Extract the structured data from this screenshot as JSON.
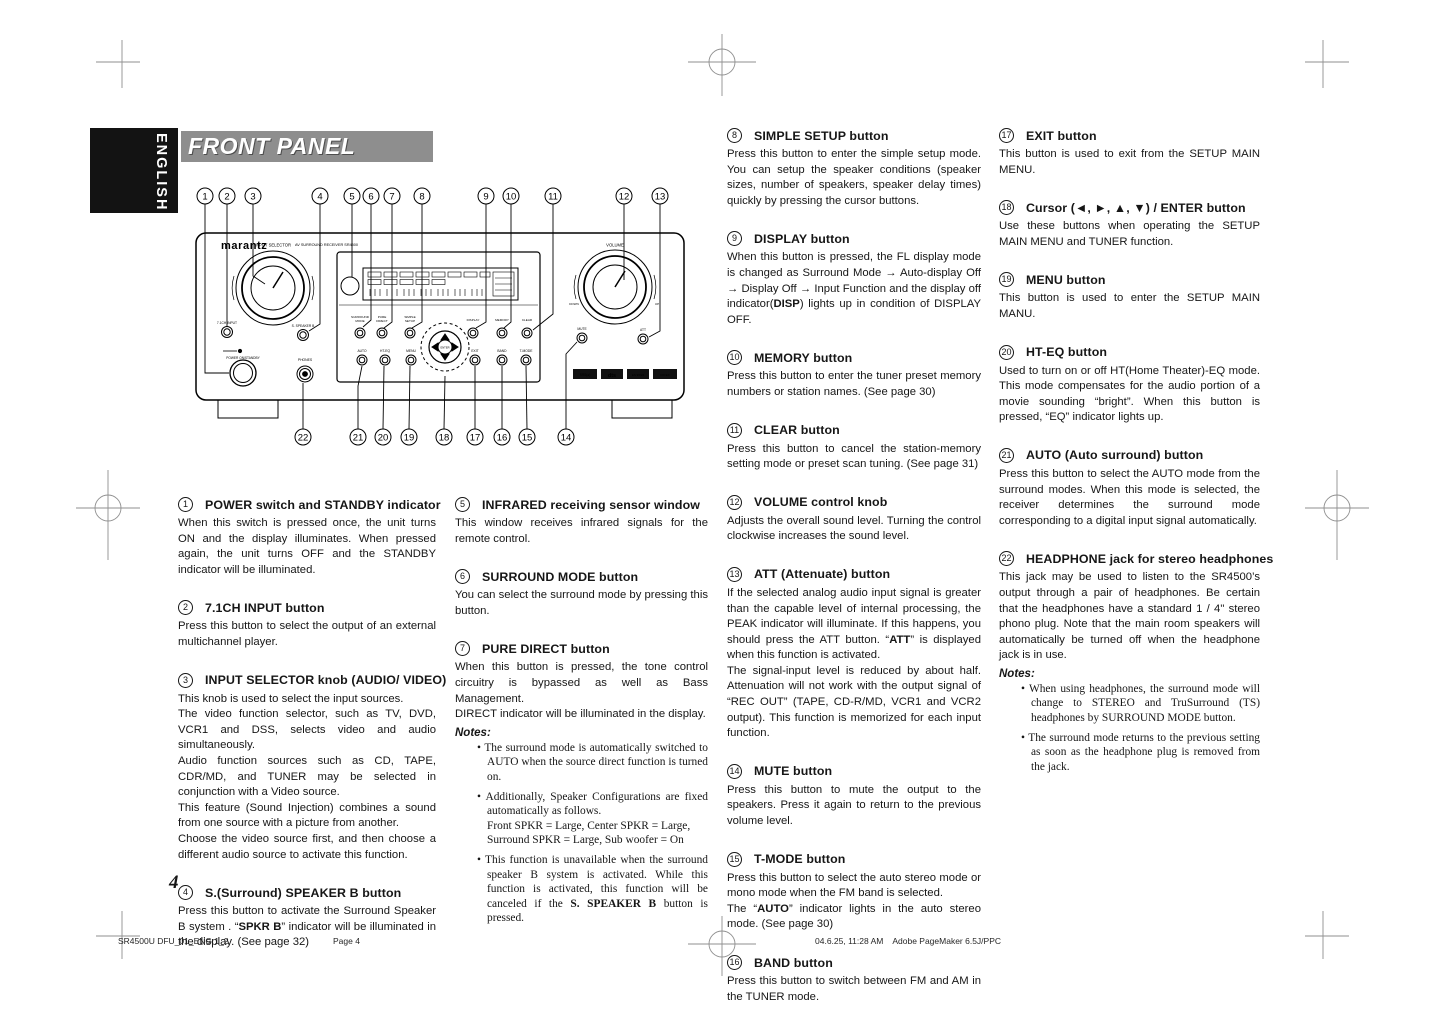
{
  "header": {
    "language": "ENGLISH",
    "title": "FRONT PANEL"
  },
  "labels": {
    "notes": "Notes:"
  },
  "diagram": {
    "brand": "marantz",
    "model": "AV SURROUND RECEIVER SR4500",
    "labels": {
      "input_selector": "INPUT SELECTOR",
      "ch71_input": "7.1CH INPUT",
      "power": "POWER ON/STANDBY",
      "speaker_b": "S. SPEAKER B",
      "phones": "PHONES",
      "surround": "SURROUND",
      "mode": "MODE",
      "pure": "PURE",
      "direct": "DIRECT",
      "simple": "SIMPLE",
      "setup": "SETUP",
      "display": "DISPLAY",
      "memory": "MEMORY",
      "clear": "CLEAR",
      "enter": "ENTER",
      "auto": "AUTO",
      "ht_eq": "HT-EQ",
      "menu": "MENU",
      "exit": "EXIT",
      "band": "BAND",
      "t_mode": "T-MODE",
      "volume": "VOLUME",
      "down": "DOWN",
      "up": "UP",
      "mute": "MUTE",
      "att": "ATT"
    },
    "badges": [
      "SRS(●)",
      "dts",
      "ES 96/24",
      "DD EX"
    ],
    "callouts_top": [
      "1",
      "2",
      "3",
      "4",
      "5",
      "6",
      "7",
      "8",
      "9",
      "10",
      "11",
      "12",
      "13"
    ],
    "callouts_bottom": [
      "22",
      "21",
      "20",
      "19",
      "18",
      "17",
      "16",
      "15",
      "14"
    ]
  },
  "sections": [
    {
      "num": "1",
      "column": 1,
      "title": "POWER switch and STANDBY indicator",
      "body": [
        "When this switch is pressed once, the unit turns ON and the display illuminates. When pressed again, the unit turns OFF and the STANDBY indicator will be illuminated."
      ]
    },
    {
      "num": "2",
      "column": 1,
      "title": "7.1CH INPUT button",
      "body": [
        "Press this button to select the output of an external multichannel player."
      ]
    },
    {
      "num": "3",
      "column": 1,
      "title": "INPUT SELECTOR knob (AUDIO/ VIDEO)",
      "body": [
        "This knob is used to select the input sources.",
        "The video function selector, such as TV, DVD, VCR1 and DSS, selects video and audio simultaneously.",
        "Audio function sources such as CD, TAPE, CDR/MD, and TUNER may be selected in conjunction with a Video source.",
        "This feature (Sound Injection) combines a sound from one source with a picture from another.",
        "Choose the video source first, and then choose a different audio source to activate this function."
      ]
    },
    {
      "num": "4",
      "column": 1,
      "title": "S.(Surround) SPEAKER B button",
      "body": [
        "Press this button to activate the Surround Speaker B system . “**SPKR B**” indicator will be illuminated in the display. (See page 32)"
      ]
    },
    {
      "num": "5",
      "column": 2,
      "title": "INFRARED receiving sensor window",
      "body": [
        "This window receives infrared signals for the remote control."
      ]
    },
    {
      "num": "6",
      "column": 2,
      "title": "SURROUND MODE button",
      "body": [
        "You can select the surround mode by pressing this button."
      ]
    },
    {
      "num": "7",
      "column": 2,
      "title": "PURE DIRECT button",
      "body": [
        "When this button is pressed, the tone control circuitry is bypassed as well as Bass Management.",
        "DIRECT indicator will be illuminated in the display."
      ],
      "notes": [
        "The surround mode is automatically switched to AUTO when the source direct function is turned on.",
        "Additionally, Speaker Configurations are fixed automatically as follows.\nFront SPKR = Large, Center SPKR = Large,\nSurround SPKR = Large, Sub woofer = On",
        "This function is unavailable when the surround speaker B system is activated. While this function is activated, this function will be canceled if the **S. SPEAKER B** button is pressed."
      ]
    },
    {
      "num": "8",
      "column": 3,
      "title": "SIMPLE SETUP button",
      "body": [
        "Press this button to enter the simple setup mode. You can setup the speaker conditions (speaker sizes, number of speakers, speaker delay times) quickly by pressing the cursor buttons."
      ]
    },
    {
      "num": "9",
      "column": 3,
      "title": "DISPLAY button",
      "body": [
        "When this button is pressed, the FL display mode is changed as Surround Mode → Auto-display Off → Display Off → Input Function  and the display off indicator(**DISP**) lights up in condition of DISPLAY OFF."
      ]
    },
    {
      "num": "10",
      "column": 3,
      "title": "MEMORY button",
      "body": [
        "Press this button to enter the tuner preset memory numbers or station names. (See page 30)"
      ]
    },
    {
      "num": "11",
      "column": 3,
      "title": "CLEAR button",
      "body": [
        "Press this button to cancel the station-memory setting mode or preset scan tuning. (See page 31)"
      ]
    },
    {
      "num": "12",
      "column": 3,
      "title": "VOLUME control knob",
      "body": [
        "Adjusts the overall sound level. Turning the control clockwise increases the sound level."
      ]
    },
    {
      "num": "13",
      "column": 3,
      "title": "ATT (Attenuate) button",
      "body": [
        "If the selected analog audio input signal is greater than the capable level of internal processing, the PEAK indicator will illuminate. If this happens, you should press the ATT button. “**ATT**” is displayed when this function is activated.",
        "The signal-input level is reduced by about half. Attenuation will not work with the output signal of “REC OUT” (TAPE, CD-R/MD, VCR1 and VCR2 output). This function is memorized for each input function."
      ]
    },
    {
      "num": "14",
      "column": 3,
      "title": "MUTE button",
      "body": [
        "Press this button to mute the output to the speakers. Press it again to return to the previous volume level."
      ]
    },
    {
      "num": "15",
      "column": 3,
      "title": "T-MODE button",
      "body": [
        "Press this button to select the auto stereo mode or mono mode when the FM band is selected.",
        "The “**AUTO**” indicator lights in the auto stereo mode. (See page 30)"
      ]
    },
    {
      "num": "16",
      "column": 3,
      "title": "BAND button",
      "body": [
        "Press this button to switch between FM and AM in the TUNER mode."
      ]
    },
    {
      "num": "17",
      "column": 4,
      "title": "EXIT button",
      "body": [
        "This button is used to exit from the SETUP MAIN MENU."
      ]
    },
    {
      "num": "18",
      "column": 4,
      "title": "Cursor (◄, ►, ▲, ▼) / ENTER button",
      "body": [
        "Use these buttons when operating the SETUP MAIN MENU and TUNER function."
      ]
    },
    {
      "num": "19",
      "column": 4,
      "title": "MENU button",
      "body": [
        "This button is used to enter the SETUP MAIN MANU."
      ]
    },
    {
      "num": "20",
      "column": 4,
      "title": "HT-EQ button",
      "body": [
        "Used to turn on or off HT(Home Theater)-EQ mode. This mode compensates for the audio portion of a movie sounding “bright”. When this button is pressed, “EQ” indicator lights up."
      ]
    },
    {
      "num": "21",
      "column": 4,
      "title": "AUTO (Auto surround) button",
      "body": [
        "Press this button to select the AUTO mode from the surround modes. When this mode is selected, the receiver determines the surround mode corresponding to a digital input signal automatically."
      ]
    },
    {
      "num": "22",
      "column": 4,
      "title": "HEADPHONE jack for stereo headphones",
      "body": [
        "This jack may be used to listen to the SR4500’s output through a pair of headphones. Be certain that the headphones have a standard 1 / 4\" stereo phono plug. Note that the main room speakers will automatically be turned off when the headphone jack is in use."
      ],
      "notes": [
        "When using headphones, the surround mode will change to STEREO and TruSurround (TS) headphones by SURROUND MODE button.",
        "The surround mode returns to the previous setting as soon as the headphone plug is removed from the jack."
      ]
    }
  ],
  "footer_area": {
    "page_number": "4",
    "document": "SR4500U DFU_01_ENG 1_2",
    "page_label": "Page 4",
    "print_info": "04.6.25, 11:28 AM    Adobe PageMaker 6.5J/PPC"
  }
}
